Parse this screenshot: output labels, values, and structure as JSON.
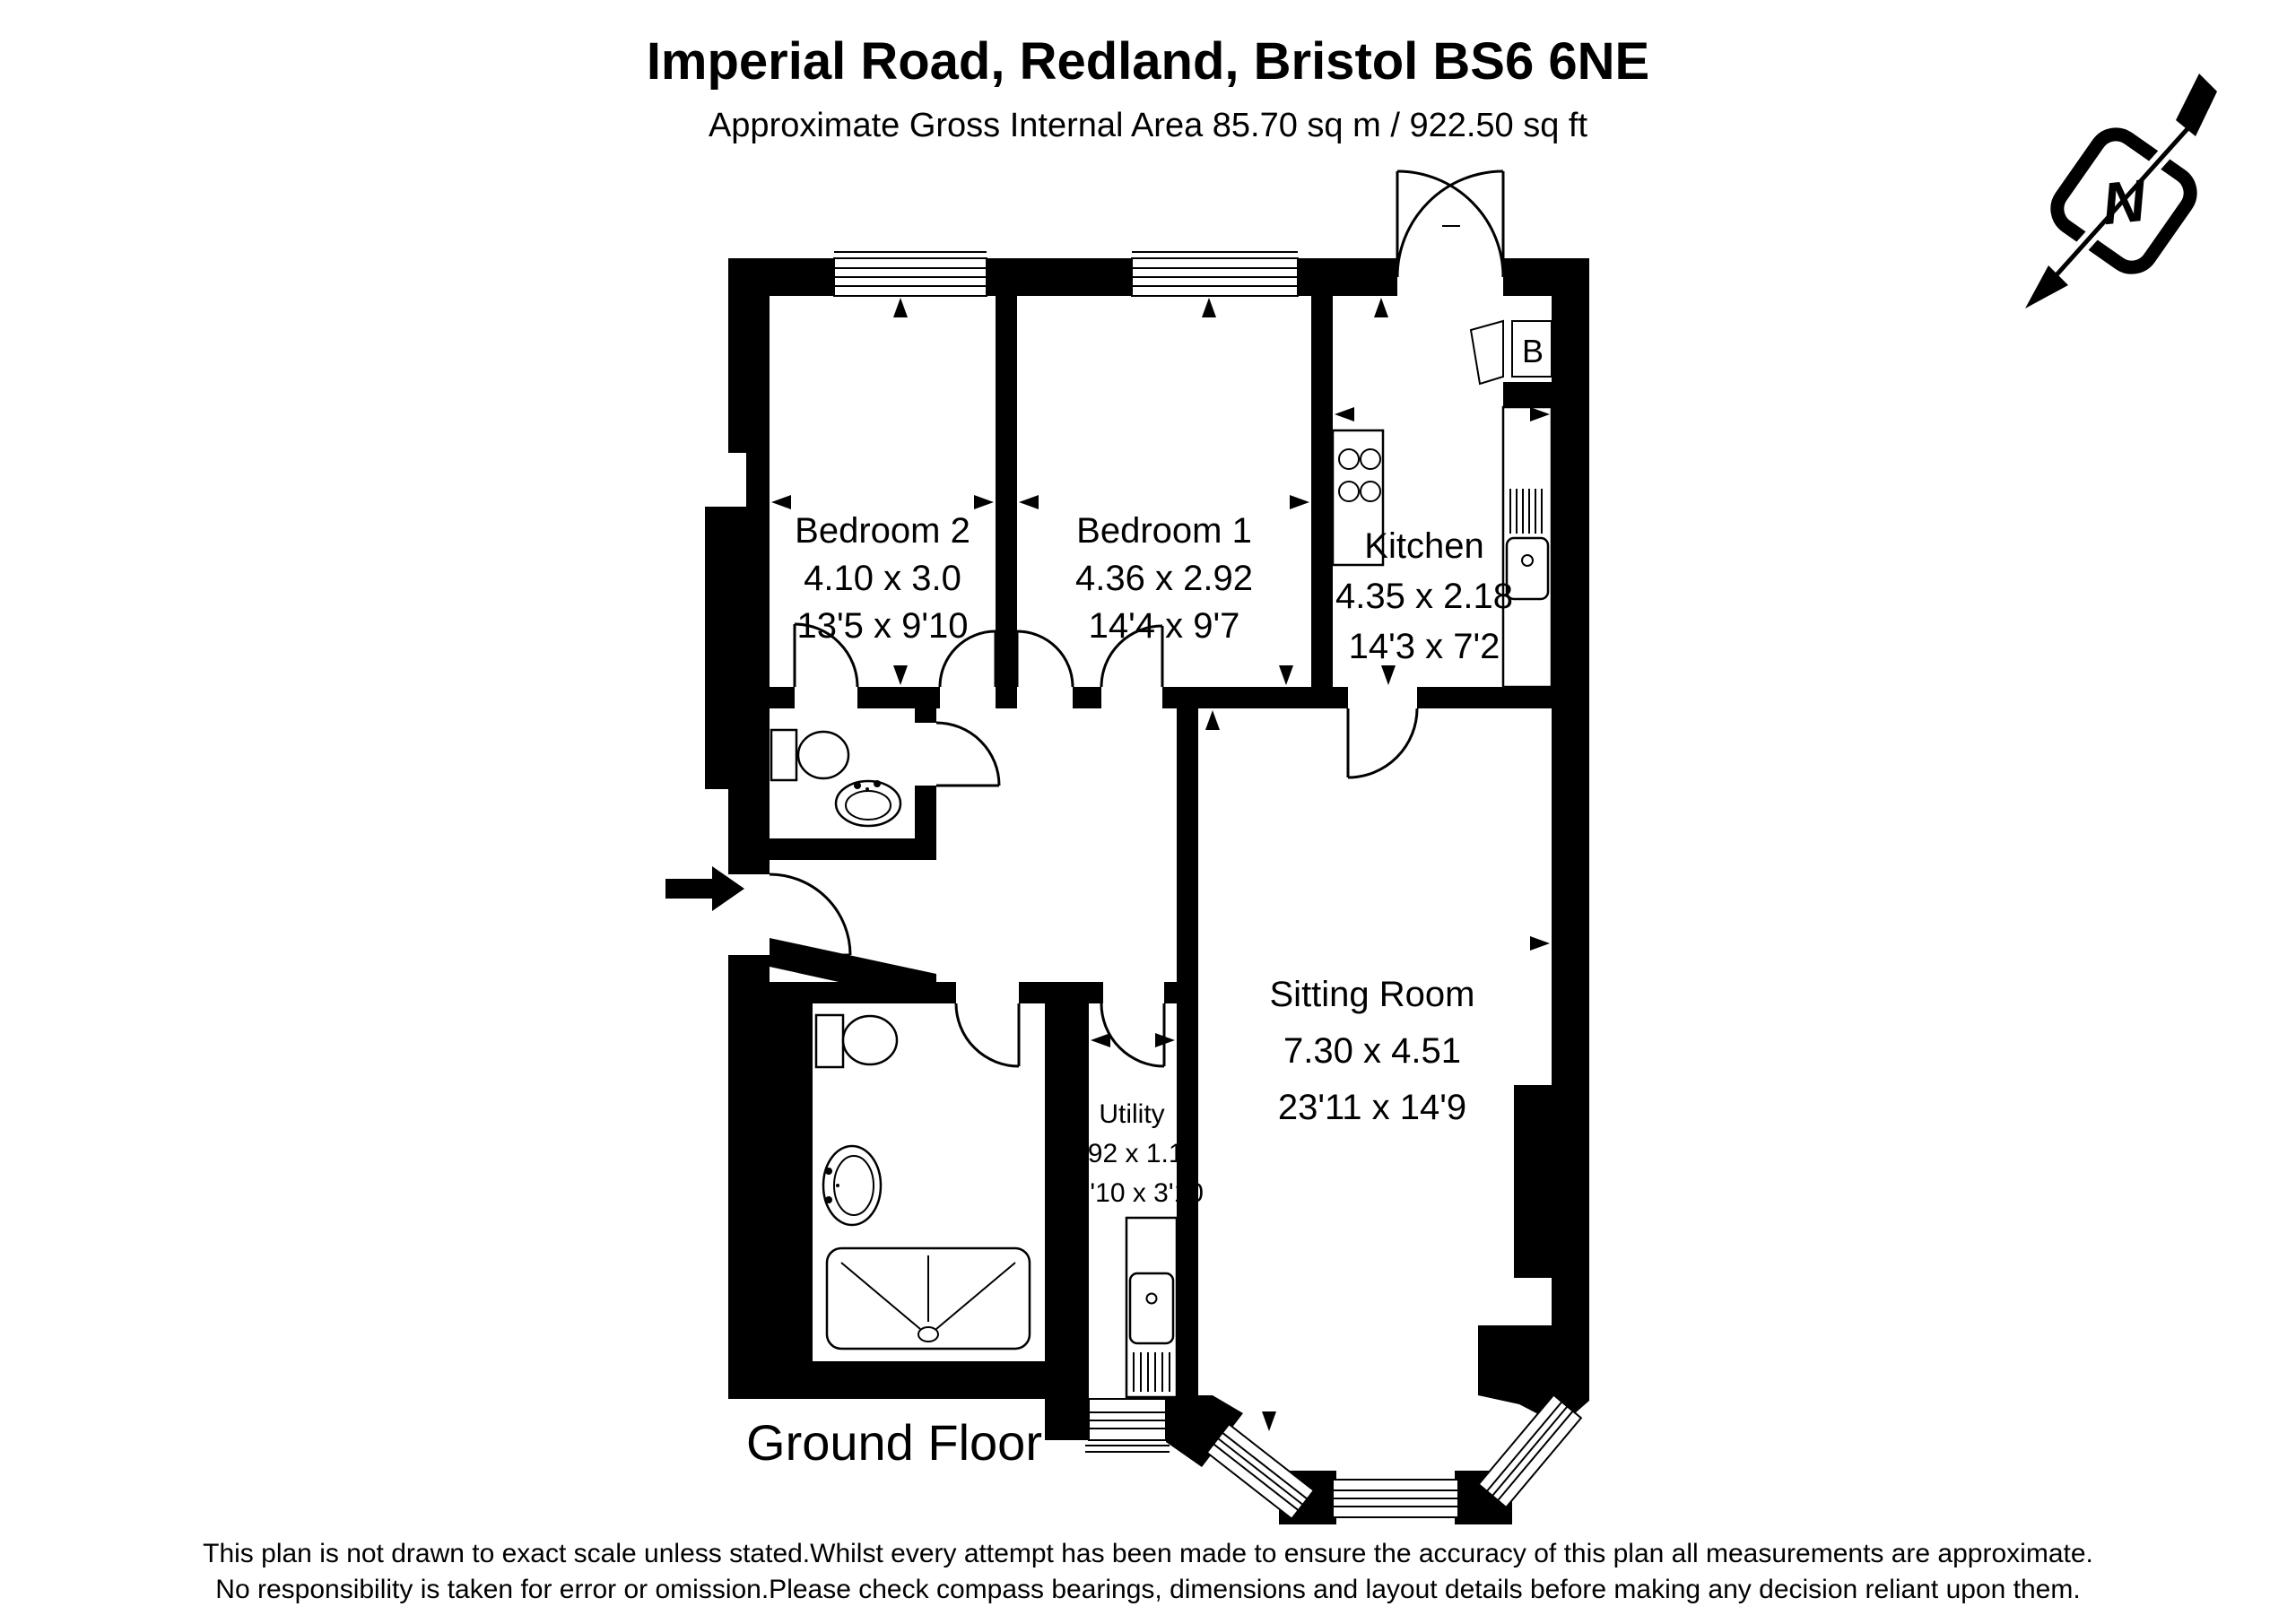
{
  "header": {
    "title": "Imperial Road, Redland, Bristol BS6 6NE",
    "subtitle": "Approximate Gross Internal Area 85.70 sq m / 922.50 sq ft"
  },
  "north": {
    "label": "N"
  },
  "rooms": {
    "bedroom2": {
      "name": "Bedroom 2",
      "metric": "4.10 x 3.0",
      "imperial": "13'5 x 9'10"
    },
    "bedroom1": {
      "name": "Bedroom 1",
      "metric": "4.36 x 2.92",
      "imperial": "14'4 x 9'7"
    },
    "kitchen": {
      "name": "Kitchen",
      "metric": "4.35 x 2.18",
      "imperial": "14'3 x 7'2"
    },
    "sitting_room": {
      "name": "Sitting Room",
      "metric": "7.30 x 4.51",
      "imperial": "23'11 x 14'9"
    },
    "utility": {
      "name": "Utility",
      "metric": "3.92 x 1.16",
      "imperial": "12'10 x 3'10"
    }
  },
  "labels": {
    "boiler": "B",
    "floor": "Ground Floor"
  },
  "footer": {
    "line1": "This plan is not drawn to exact scale unless stated.Whilst every attempt has been made to ensure the accuracy of this plan all measurements are approximate.",
    "line2": "No responsibility is taken for error or omission.Please check compass bearings, dimensions and layout details before making any decision reliant upon them."
  },
  "colors": {
    "ink": "#000000",
    "paper": "#ffffff"
  }
}
